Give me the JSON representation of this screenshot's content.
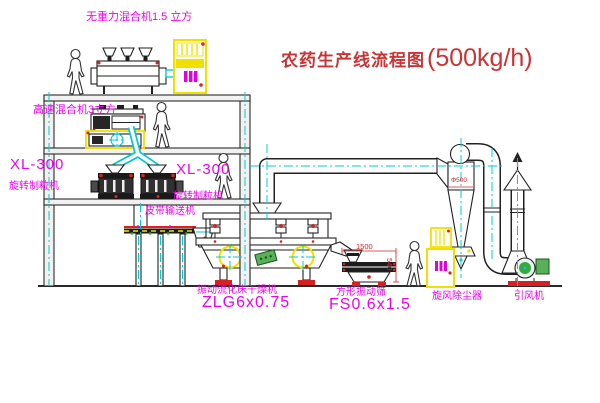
{
  "title": {
    "main": "农药生产线流程图",
    "capacity": "(500kg/h)"
  },
  "labels": {
    "roof_mixer": "无重力混合机1.5 立方",
    "floor2_mixer": "高速混合机3立方",
    "left_granulator_model": "XL-300",
    "left_granulator_name": "旋转制粒机",
    "right_granulator_model": "XL-300",
    "right_granulator_name": "旋转制粒机",
    "belt_conveyor": "皮带输送机",
    "dryer_name": "振动流化床干燥机",
    "dryer_model": "ZLG6x0.75",
    "sieve_name": "方形振动筛",
    "sieve_model": "FS0.6x1.5",
    "cyclone_name": "旋风除尘器",
    "fan_name": "引风机"
  },
  "dimensions": {
    "sieve_length": "1500",
    "sieve_height": "540",
    "cyclone_diameter": "Φ500"
  },
  "colors": {
    "label_magenta": "#ee00ee",
    "title_red": "#cc3333",
    "dim_red": "#dd2222",
    "machine_yellow": "#f0e000",
    "centerline_cyan": "#00cccc",
    "fan_green": "#3aa83a",
    "foot_red": "#d82020"
  }
}
